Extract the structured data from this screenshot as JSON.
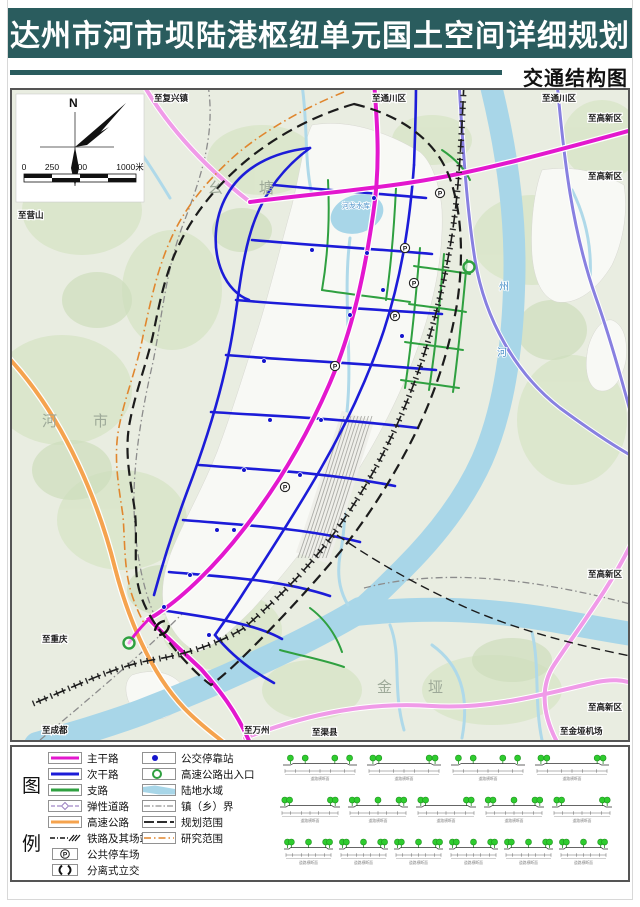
{
  "header": {
    "title": "达州市河市坝陆港枢纽单元国土空间详细规划",
    "subtitle": "交通结构图"
  },
  "colors": {
    "banner": "#2A5C5E",
    "trunk_road": "#E318CE",
    "secondary_road": "#1C1CD8",
    "branch_road": "#2FA040",
    "highway": "#F5A34E",
    "regional_road": "#F09BE8",
    "water": "#A8D6E8",
    "research_boundary": "#E0862E",
    "planning_boundary": "#1C1C1C"
  },
  "map": {
    "compass_n": "N",
    "scale_labels": [
      "0",
      "250",
      "500",
      "1000米"
    ],
    "labels": [
      {
        "t": "至复兴镇",
        "x": 142,
        "y": 11,
        "cls": "edge",
        "anchor": "start"
      },
      {
        "t": "至通川区",
        "x": 360,
        "y": 11,
        "cls": "edge",
        "anchor": "start"
      },
      {
        "t": "至通川区",
        "x": 530,
        "y": 11,
        "cls": "edge",
        "anchor": "start"
      },
      {
        "t": "至高新区",
        "x": 610,
        "y": 31,
        "cls": "edge",
        "anchor": "end"
      },
      {
        "t": "至高新区",
        "x": 610,
        "y": 89,
        "cls": "edge",
        "anchor": "end"
      },
      {
        "t": "至高新区",
        "x": 610,
        "y": 487,
        "cls": "edge",
        "anchor": "end"
      },
      {
        "t": "至高新区",
        "x": 610,
        "y": 620,
        "cls": "edge",
        "anchor": "end"
      },
      {
        "t": "至营山",
        "x": 6,
        "y": 128,
        "cls": "edge",
        "anchor": "start"
      },
      {
        "t": "至重庆",
        "x": 30,
        "y": 552,
        "cls": "edge",
        "anchor": "start"
      },
      {
        "t": "至成都",
        "x": 30,
        "y": 643,
        "cls": "edge",
        "anchor": "start"
      },
      {
        "t": "至万州",
        "x": 232,
        "y": 643,
        "cls": "edge",
        "anchor": "start"
      },
      {
        "t": "至渠县",
        "x": 300,
        "y": 645,
        "cls": "edge",
        "anchor": "start"
      },
      {
        "t": "至金垭机场",
        "x": 548,
        "y": 644,
        "cls": "edge",
        "anchor": "start"
      },
      {
        "t": "幺塘",
        "x": 196,
        "y": 103,
        "cls": "area",
        "ls": 36
      },
      {
        "t": "河市",
        "x": 30,
        "y": 336,
        "cls": "area",
        "ls": 36
      },
      {
        "t": "金垭",
        "x": 365,
        "y": 602,
        "cls": "area",
        "ls": 36
      },
      {
        "t": "河龙水库",
        "x": 330,
        "y": 118,
        "cls": "water",
        "size": 7
      },
      {
        "t": "州",
        "x": 487,
        "y": 200,
        "cls": "water",
        "size": 10
      },
      {
        "t": "河",
        "x": 485,
        "y": 266,
        "cls": "water",
        "size": 10
      }
    ],
    "markers": {
      "parking_glyph": "P",
      "parking": [
        [
          428,
          103
        ],
        [
          393,
          158
        ],
        [
          402,
          193
        ],
        [
          383,
          226
        ],
        [
          323,
          276
        ],
        [
          273,
          397
        ]
      ],
      "bus_stops": [
        [
          362,
          108
        ],
        [
          355,
          163
        ],
        [
          300,
          160
        ],
        [
          338,
          225
        ],
        [
          252,
          271
        ],
        [
          309,
          330
        ],
        [
          288,
          385
        ],
        [
          232,
          380
        ],
        [
          205,
          440
        ],
        [
          178,
          485
        ],
        [
          152,
          517
        ],
        [
          371,
          200
        ],
        [
          390,
          246
        ],
        [
          258,
          330
        ],
        [
          222,
          440
        ],
        [
          197,
          545
        ]
      ],
      "entrances": [
        [
          117,
          553
        ],
        [
          457,
          177
        ]
      ],
      "interchanges": [
        [
          150,
          538
        ]
      ]
    }
  },
  "legend": {
    "side_chars": [
      "图",
      "例"
    ],
    "col1": [
      {
        "label": "主干路",
        "type": "trunk"
      },
      {
        "label": "次干路",
        "type": "secondary"
      },
      {
        "label": "支路",
        "type": "branch"
      },
      {
        "label": "弹性道路",
        "type": "elastic"
      },
      {
        "label": "高速公路",
        "type": "highway"
      },
      {
        "label": "铁路及其场站",
        "type": "railway"
      },
      {
        "label": "公共停车场",
        "type": "parking"
      },
      {
        "label": "分离式立交",
        "type": "interchange"
      }
    ],
    "col2": [
      {
        "label": "公交停靠站",
        "type": "bus"
      },
      {
        "label": "高速公路出入口",
        "type": "entrance"
      },
      {
        "label": "陆地水域",
        "type": "water"
      },
      {
        "label": "镇（乡）界",
        "type": "town"
      },
      {
        "label": "规划范围",
        "type": "planning"
      },
      {
        "label": "研究范围",
        "type": "research"
      }
    ]
  },
  "cross_sections": {
    "caption": "道路横断面",
    "rows": [
      {
        "count": 4,
        "w": 74,
        "gap": 10,
        "y": 4
      },
      {
        "count": 5,
        "w": 60,
        "gap": 8,
        "y": 46
      },
      {
        "count": 6,
        "w": 49,
        "gap": 6,
        "y": 88
      }
    ]
  }
}
